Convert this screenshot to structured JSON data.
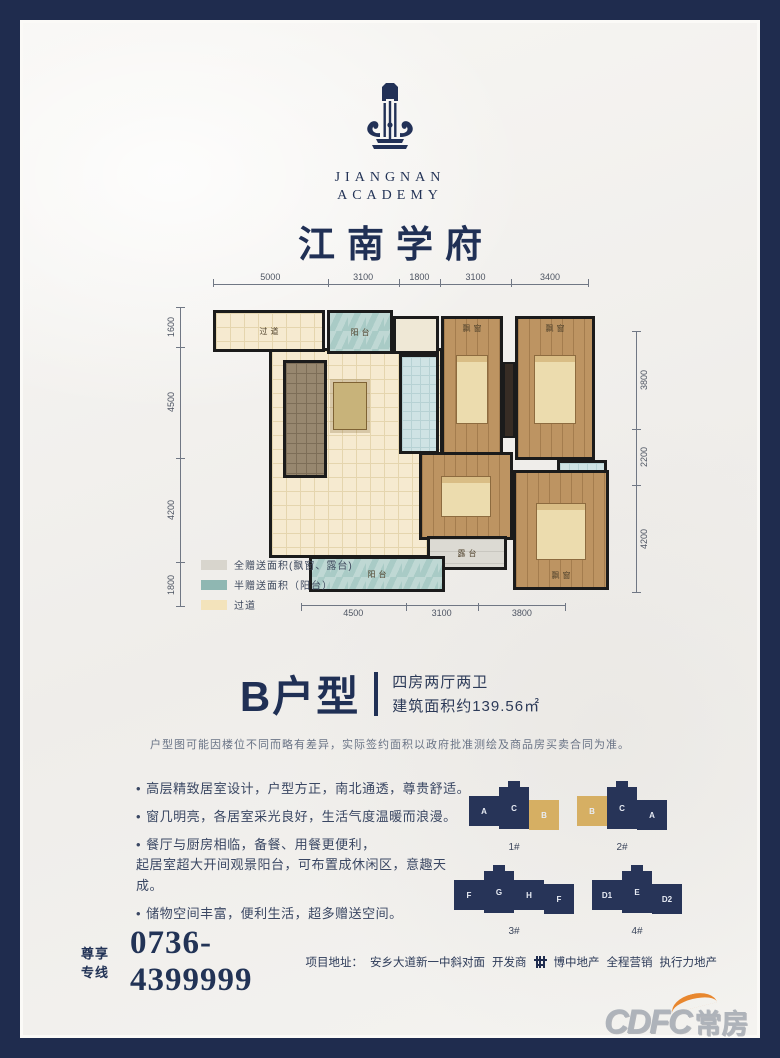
{
  "brand": {
    "en_line1": "JIANGNAN",
    "en_line2": "ACADEMY",
    "title_cn": "江南学府"
  },
  "plan": {
    "dims_top": [
      5000,
      3100,
      1800,
      3100,
      3400
    ],
    "dims_left": [
      1600,
      4500,
      4200,
      1800
    ],
    "dims_right": [
      3800,
      2200,
      4200
    ],
    "dims_bottom": [
      4500,
      3100,
      3800
    ],
    "labels": {
      "corridor": "过道",
      "balcony_top": "阳台",
      "bay_window_1": "飘窗",
      "bay_window_2": "飘窗",
      "terrace": "露台",
      "bay_window_3": "飘窗",
      "balcony_bottom": "阳台"
    },
    "legend": [
      {
        "color": "#d8d5cd",
        "label": "全赠送面积(飘窗、露台)"
      },
      {
        "color": "#8fb7b2",
        "label": "半赠送面积（阳台）"
      },
      {
        "color": "#f3e3bb",
        "label": "过道"
      }
    ]
  },
  "unit": {
    "name": "B户型",
    "type_desc": "四房两厅两卫",
    "area_desc": "建筑面积约139.56㎡"
  },
  "disclaimer": "户型图可能因楼位不同而略有差异，实际签约面积以政府批准测绘及商品房买卖合同为准。",
  "features": [
    "高层精致居室设计，户型方正，南北通透，尊贵舒适。",
    "窗几明亮，各居室采光良好，生活气度温暖而浪漫。",
    "餐厅与厨房相临，备餐、用餐更便利，\n起居室超大开间观景阳台，可布置成休闲区，意趣天成。",
    "储物空间丰富，便利生活，超多赠送空间。"
  ],
  "buildings": {
    "items": [
      {
        "caption": "1#",
        "units": [
          {
            "label": "A"
          },
          {
            "label": "C"
          },
          {
            "label": "B",
            "highlight": true
          }
        ]
      },
      {
        "caption": "2#",
        "units": [
          {
            "label": "B",
            "highlight": true
          },
          {
            "label": "C"
          },
          {
            "label": "A"
          }
        ]
      },
      {
        "caption": "3#",
        "units": [
          {
            "label": "F"
          },
          {
            "label": "G"
          },
          {
            "label": "H"
          },
          {
            "label": "F"
          }
        ]
      },
      {
        "caption": "4#",
        "units": [
          {
            "label": "D1"
          },
          {
            "label": "E"
          },
          {
            "label": "D2"
          }
        ]
      }
    ]
  },
  "contact": {
    "hotline_label": "尊享专线",
    "hotline_number": "0736-4399999",
    "address_label": "项目地址：",
    "address": "安乡大道新一中斜对面",
    "developer_label": "开发商",
    "developer": "博中地产",
    "marketing": "全程营销",
    "agency": "执行力地产"
  },
  "watermark": {
    "text_en": "CDFC",
    "text_cn": "常房"
  },
  "colors": {
    "navy": "#273458",
    "gold": "#d6af63",
    "teal": "#a9cbc6",
    "cream": "#f6ead0",
    "gray": "#d8d5cd"
  }
}
